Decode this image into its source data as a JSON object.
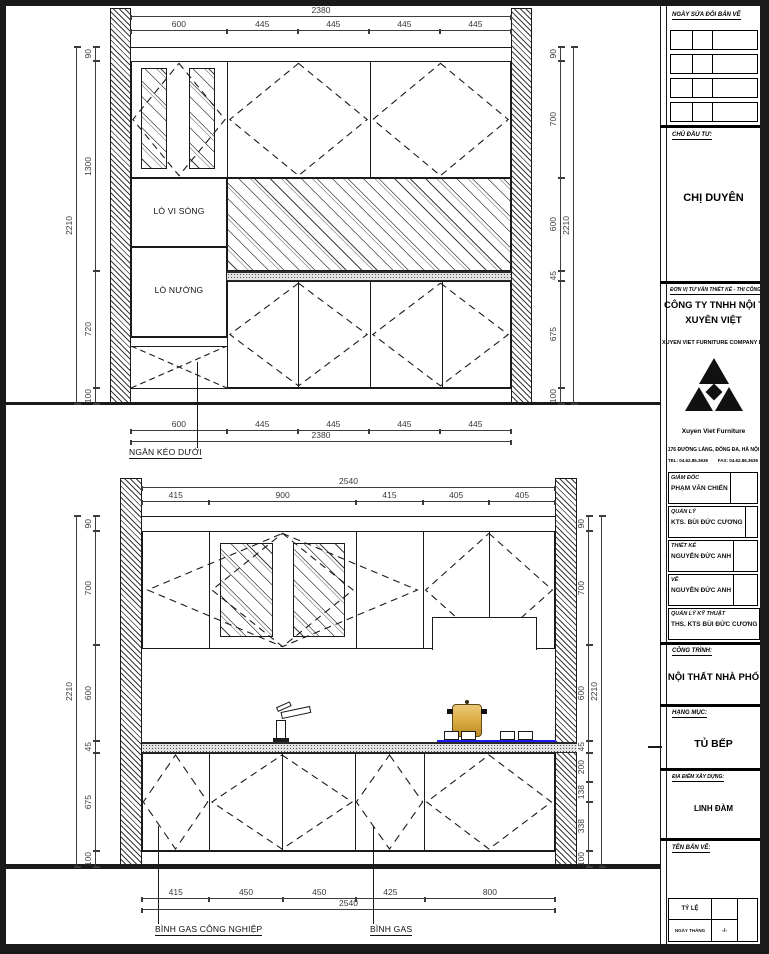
{
  "title_block": {
    "revision_header": "NGÀY SỬA ĐỔI BẢN VẼ",
    "client_label": "CHỦ ĐẦU TƯ:",
    "client_name": "CHỊ DUYÊN",
    "consultant_label": "ĐƠN VỊ TƯ VẤN THIẾT KẾ - THI CÔNG",
    "company_name_line1": "CÔNG TY TNHH NỘI THẤT",
    "company_name_line2": "XUYÊN VIỆT",
    "company_name_en": "XUYEN VIET FURNITURE COMPANY LIMITED",
    "logo_caption": "Xuyen Viet Furniture",
    "address": "176 ĐƯỜNG LÁNG, ĐỐNG ĐA, HÀ NỘI",
    "tel": "TEL: 04.62.86.3636",
    "fax": "FAX: 04.62.86.3636",
    "staff": [
      {
        "role": "GIÁM ĐỐC",
        "name": "PHẠM VĂN CHIẾN"
      },
      {
        "role": "QUẢN LÝ",
        "name": "KTS. BÙI ĐỨC CƯƠNG"
      },
      {
        "role": "THIẾT KẾ",
        "name": "NGUYỄN ĐỨC ANH"
      },
      {
        "role": "VẼ",
        "name": "NGUYỄN ĐỨC ANH"
      },
      {
        "role": "QUẢN LÝ KỸ THUẬT",
        "name": "THS. KTS BÙI ĐỨC CƯƠNG"
      }
    ],
    "project_label": "CÔNG TRÌNH:",
    "project_name": "NỘI THẤT NHÀ PHỐ",
    "category_label": "HẠNG MỤC:",
    "category_name": "TỦ BẾP",
    "location_label": "ĐỊA ĐIỂM XÂY DỰNG:",
    "location_name": "LINH ĐÀM",
    "drawing_name_label": "TÊN BẢN VẼ:",
    "scale_label": "TỶ LỆ",
    "date_label": "NGÀY THÁNG",
    "date_value": "-/-"
  },
  "elevation_top": {
    "labels": {
      "microwave": "LÒ VI SÓNG",
      "oven": "LÒ NƯỚNG",
      "drawer": "NGĂN KÉO DƯỚI"
    },
    "dim_total_width": "2380",
    "dims_top": [
      "600",
      "445",
      "445",
      "445",
      "445"
    ],
    "dims_bottom": [
      "600",
      "445",
      "445",
      "445",
      "445"
    ],
    "dim_total_height": "2210",
    "dims_left": [
      "90",
      "1300",
      "720",
      "100"
    ],
    "dims_right": [
      "90",
      "700",
      "600",
      "45",
      "675",
      "100"
    ]
  },
  "elevation_bottom": {
    "labels": {
      "gas_industrial": "BÌNH GAS CÔNG NGHIỆP",
      "gas": "BÌNH GAS"
    },
    "dim_total_width": "2540",
    "dims_top": [
      "415",
      "900",
      "415",
      "405",
      "405"
    ],
    "dims_bottom": [
      "415",
      "450",
      "450",
      "425",
      "800"
    ],
    "dim_total_height": "2210",
    "dims_left": [
      "90",
      "700",
      "600",
      "45",
      "675",
      "100"
    ],
    "dims_right": [
      "90",
      "700",
      "600",
      "45",
      "200",
      "138",
      "338",
      "100"
    ]
  },
  "colors": {
    "line": "#1a1a1a",
    "cooktop_blue": "#1a1aee",
    "pot_gold": "#d8a93f"
  }
}
